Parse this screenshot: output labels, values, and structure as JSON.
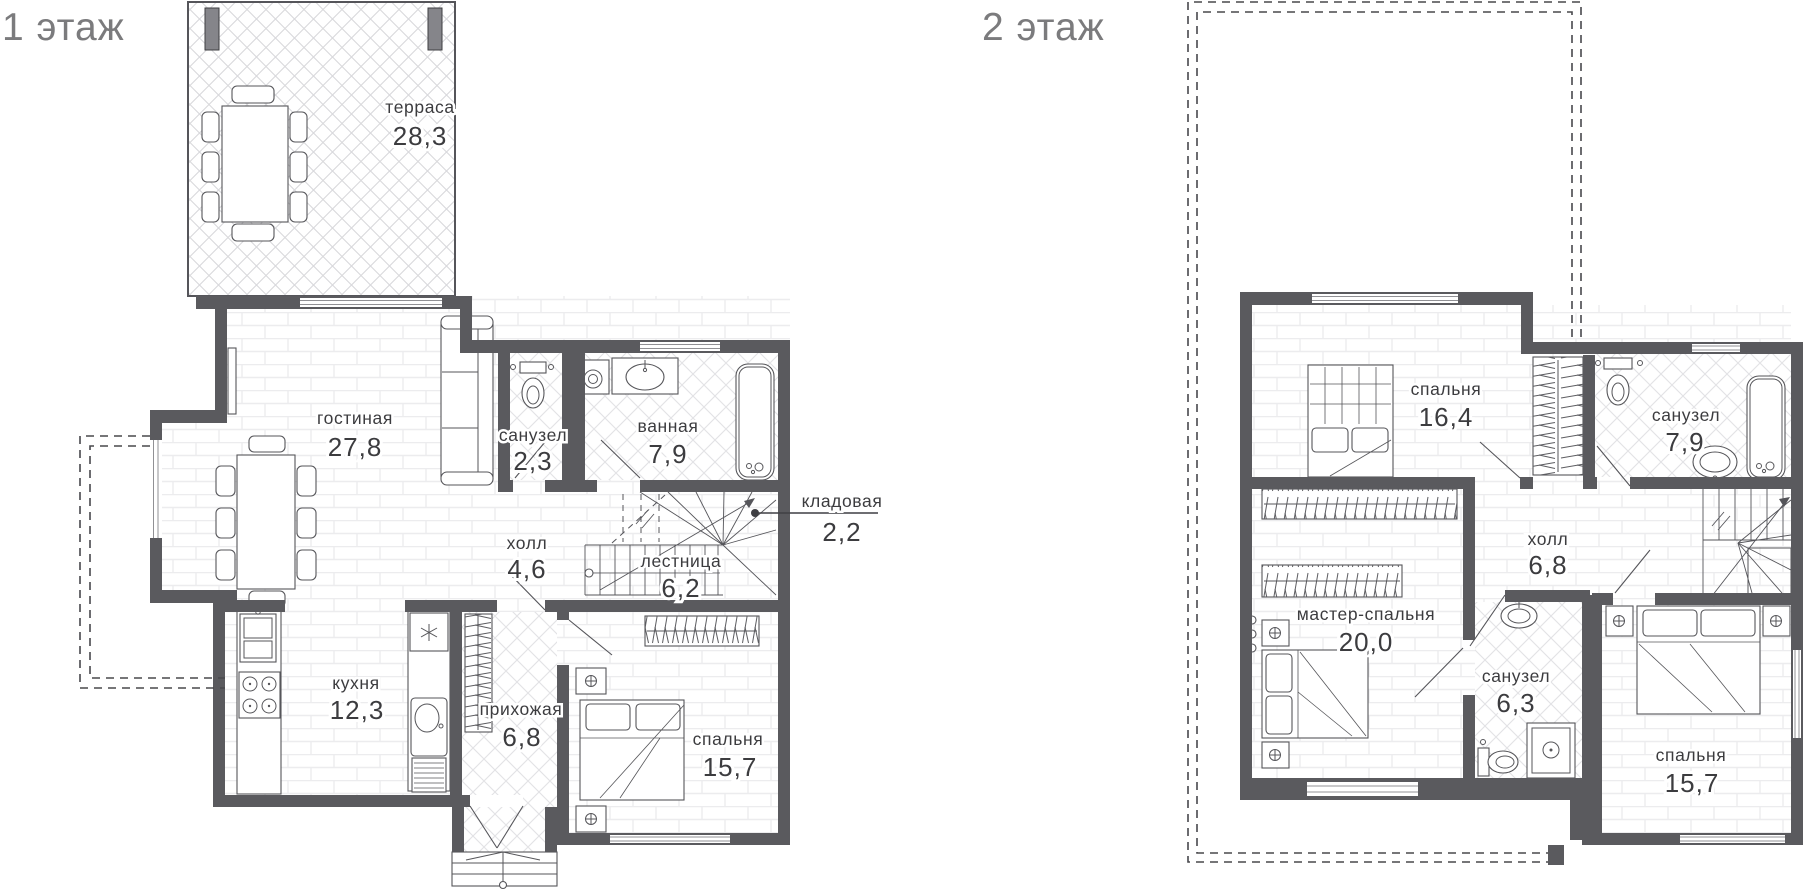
{
  "page": {
    "background": "#ffffff"
  },
  "colors": {
    "wall": "#5a5a5e",
    "wall_edge": "#3f3f43",
    "pillar": "#85858a",
    "label": "#3c3c3f",
    "title": "#7b7b7d",
    "floor_line": "#ececee",
    "tile_line": "#e2e2e5"
  },
  "floor1": {
    "title": "1 этаж",
    "rooms": {
      "terrace": {
        "name": "терраса",
        "area": "28,3"
      },
      "living": {
        "name": "гостиная",
        "area": "27,8"
      },
      "wc": {
        "name": "санузел",
        "area": "2,3"
      },
      "bath": {
        "name": "ванная",
        "area": "7,9"
      },
      "storage": {
        "name": "кладовая",
        "area": "2,2"
      },
      "hall": {
        "name": "холл",
        "area": "4,6"
      },
      "stairs": {
        "name": "лестница",
        "area": "6,2"
      },
      "kitchen": {
        "name": "кухня",
        "area": "12,3"
      },
      "entry": {
        "name": "прихожая",
        "area": "6,8"
      },
      "bedroom": {
        "name": "спальня",
        "area": "15,7"
      }
    }
  },
  "floor2": {
    "title": "2 этаж",
    "rooms": {
      "bedroom1": {
        "name": "спальня",
        "area": "16,4"
      },
      "bath": {
        "name": "санузел",
        "area": "7,9"
      },
      "hall": {
        "name": "холл",
        "area": "6,8"
      },
      "master": {
        "name": "мастер-спальня",
        "area": "20,0"
      },
      "wc": {
        "name": "санузел",
        "area": "6,3"
      },
      "bedroom2": {
        "name": "спальня",
        "area": "15,7"
      }
    }
  }
}
